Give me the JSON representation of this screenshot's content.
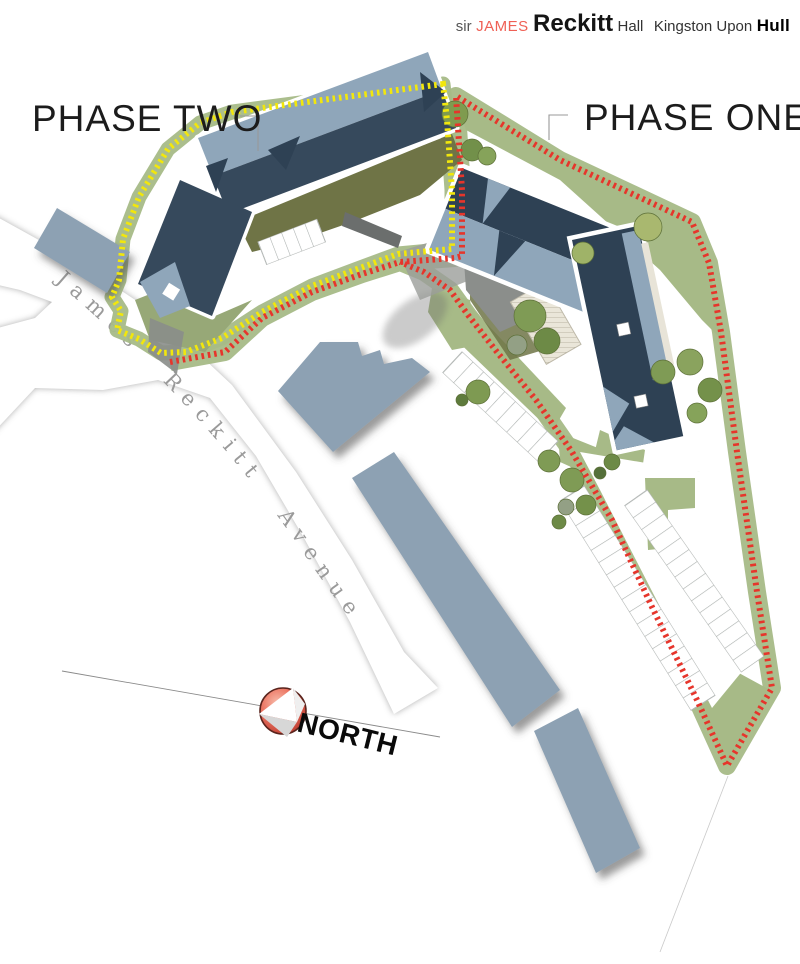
{
  "header": {
    "prefix": "sir",
    "first_name": "JAMES",
    "surname": "Reckitt",
    "suffix": "Hall",
    "city": "Kingston Upon",
    "city_bold": "Hull"
  },
  "labels": {
    "phase_two": "PHASE TWO",
    "phase_one": "PHASE ONE"
  },
  "road": {
    "name": "James Reckitt Avenue"
  },
  "compass": {
    "label": "NORTH"
  },
  "colors": {
    "boundary_red": "#e6352b",
    "boundary_yellow": "#f2e70c",
    "roof_dark": "#36495c",
    "roof_mid": "#2e4154",
    "roof_light": "#8fa6ba",
    "landscape": "#a7ba87",
    "olive": "#6f7446",
    "existing": "#8da1b3",
    "header_red": "#ef6055",
    "road_text": "#9a9a9a",
    "ink": "#1c1c1c"
  }
}
